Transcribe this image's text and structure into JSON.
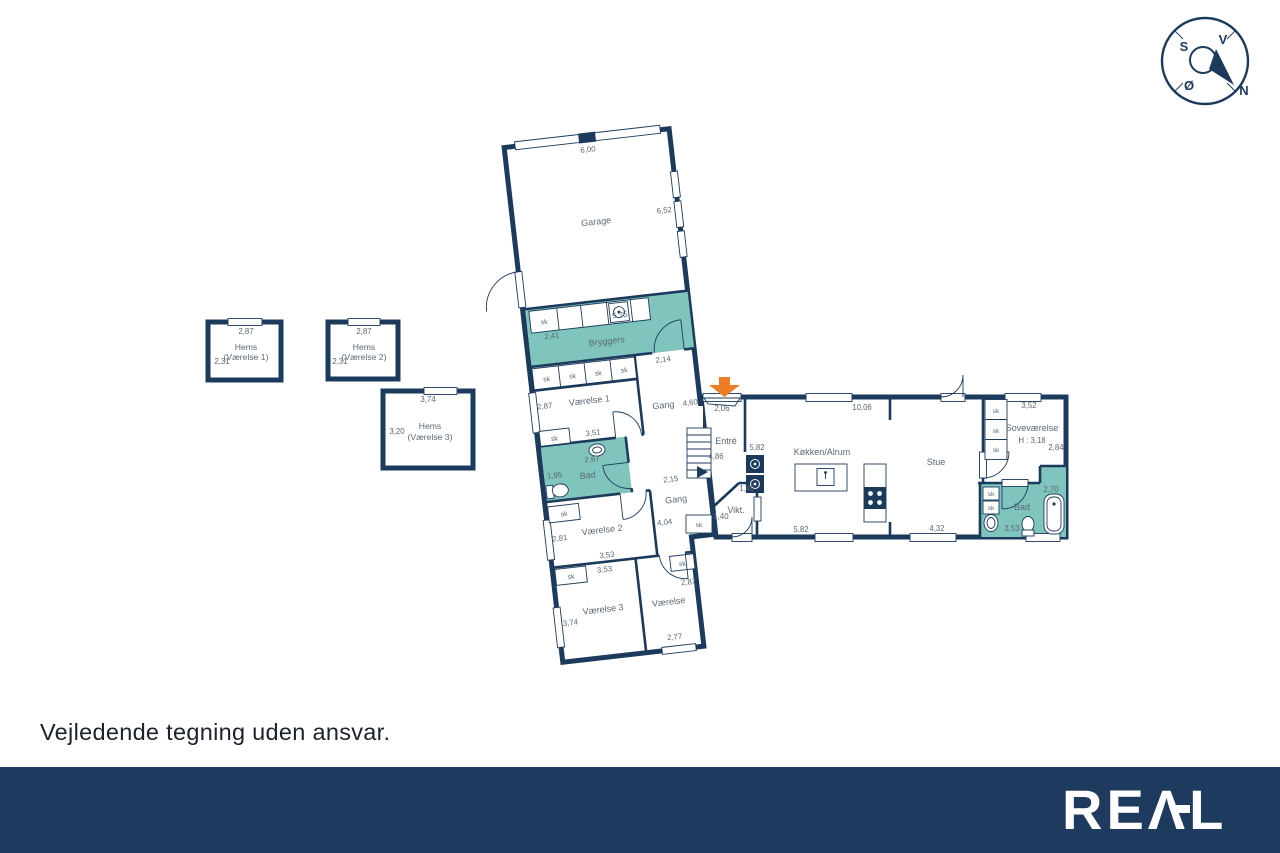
{
  "page": {
    "disclaimer": "Vejledende tegning uden ansvar.",
    "brand_display": "REΛL"
  },
  "colors": {
    "wall_navy": "#1c3a5c",
    "room_teal": "#7fc5bd",
    "entrance_arrow_orange": "#ed7d26",
    "footer_navy": "#1e3a5e",
    "label_gray": "#5a6772"
  },
  "compass": {
    "nw": "S",
    "ne": "V",
    "sw": "Ø",
    "se": "N"
  },
  "labels": {
    "sk": "sk"
  },
  "hems": [
    {
      "title": "Hems",
      "subtitle": "(Værelse 1)",
      "width": "2,87",
      "depth": "2,31"
    },
    {
      "title": "Hems",
      "subtitle": "(Værelse 2)",
      "width": "2,87",
      "depth": "2,31"
    },
    {
      "title": "Hems",
      "subtitle": "(Værelse 3)",
      "width": "3,74",
      "depth": "3,20"
    }
  ],
  "rooms": {
    "garage": {
      "name": "Garage",
      "w_top": "6,00",
      "h_right": "6,52"
    },
    "bryggers": {
      "name": "Bryggers",
      "h_left": "2,41",
      "w": "5,75"
    },
    "gang1": {
      "name": "Gang",
      "w_top": "2,14",
      "len": "4,60"
    },
    "vaerelse1": {
      "name": "Værelse 1",
      "h": "2,87",
      "w": "3,51"
    },
    "bad1": {
      "name": "Bad",
      "w": "2,67",
      "h": "1,95"
    },
    "gang2": {
      "name": "Gang",
      "w_top": "2,15",
      "len": "4,04"
    },
    "vaerelse2": {
      "name": "Værelse 2",
      "h": "2,81",
      "w": "3,53"
    },
    "vaerelse3": {
      "name": "Værelse 3",
      "h": "3,74",
      "w_top": "3,53"
    },
    "vaerelse4": {
      "name": "Værelse",
      "h": "2,87",
      "w": "2,77"
    },
    "entre": {
      "name": "Entré",
      "door": "2,06",
      "stairs": "4,86",
      "h": "5,82"
    },
    "koekken": {
      "name": "Køkken/Alrum",
      "w_top": "10,06",
      "w_bottom": "5,82"
    },
    "vikt": {
      "name": "Vikt.",
      "d1": "1,40",
      "d2": "1,40"
    },
    "stue": {
      "name": "Stue",
      "w": "4,32"
    },
    "sovevaerelse": {
      "name": "Soveværelse",
      "note": "H : 3,18",
      "w": "3,52",
      "h": "2,84"
    },
    "bad2": {
      "name": "Bad",
      "h": "2,70",
      "w": "3,53"
    }
  }
}
